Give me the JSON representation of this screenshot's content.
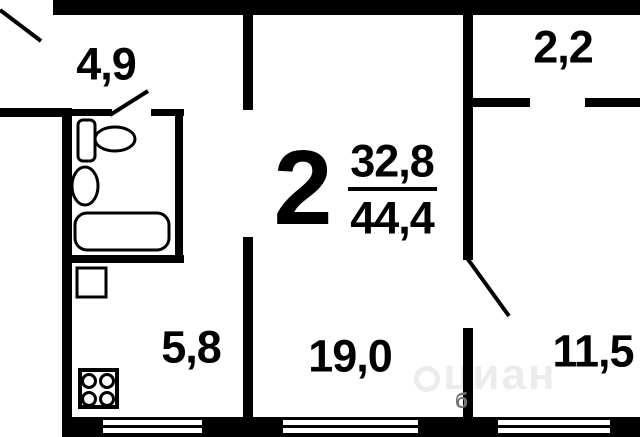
{
  "plan": {
    "rooms_count": "2",
    "area_living": "32,8",
    "area_total": "44,4"
  },
  "rooms": [
    {
      "name": "hallway",
      "area": "4,9"
    },
    {
      "name": "balcony",
      "area": "2,2"
    },
    {
      "name": "kitchen",
      "area": "5,8"
    },
    {
      "name": "living-room",
      "area": "19,0"
    },
    {
      "name": "bedroom",
      "area": "11,5"
    }
  ],
  "fixtures": [
    "sink",
    "toilet",
    "bathtub",
    "washing-machine",
    "stove"
  ],
  "watermark": {
    "text": "циан",
    "badge": "б"
  },
  "colors": {
    "wall": "#000000",
    "background": "#ffffff",
    "watermark": "#ececec"
  }
}
